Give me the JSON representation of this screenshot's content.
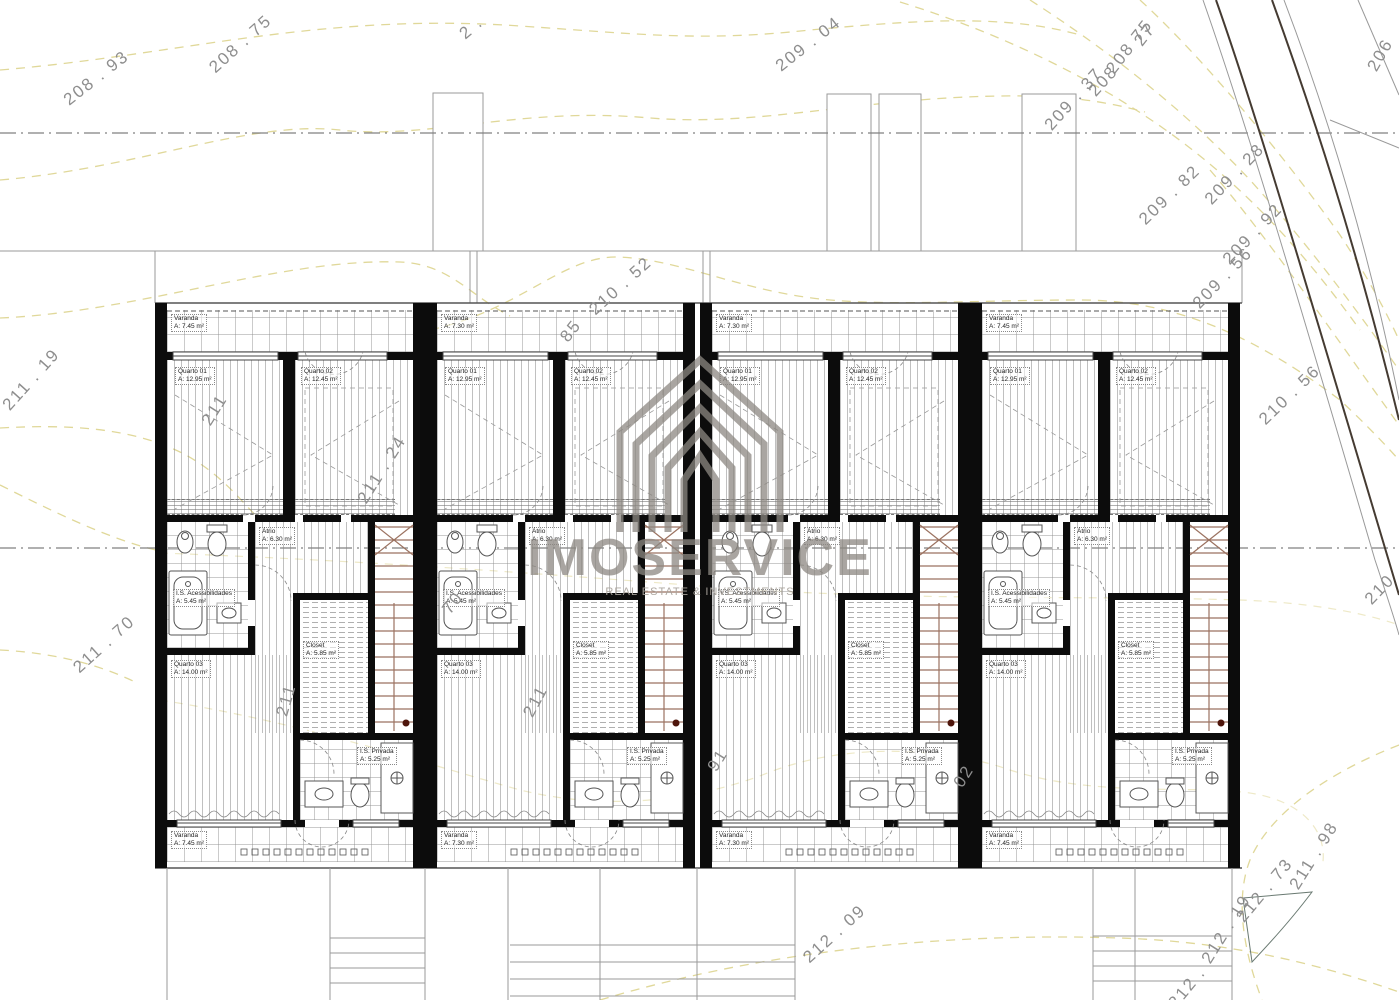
{
  "watermark": {
    "brand": "IMOSERVICE",
    "tagline": "REAL ESTATE & INVESTMENTS",
    "logo": "nested-chevron-house",
    "color": "#8d8882"
  },
  "building": {
    "units": [
      {
        "id": "Unit 1",
        "rooms": [
          {
            "key": "varanda-top",
            "name": "Varanda",
            "area": "A: 7.45 m²"
          },
          {
            "key": "quarto-01",
            "name": "Quarto 01",
            "area": "A: 12.95 m²"
          },
          {
            "key": "quarto-02",
            "name": "Quarto 02",
            "area": "A: 12.45 m²"
          },
          {
            "key": "atrio",
            "name": "Átrio",
            "area": "A: 6.30 m²"
          },
          {
            "key": "is-acessibilidades",
            "name": "I.S. Acessibilidades",
            "area": "A: 5.45 m²"
          },
          {
            "key": "quarto-03",
            "name": "Quarto 03",
            "area": "A: 14.00 m²"
          },
          {
            "key": "closet",
            "name": "Closet",
            "area": "A: 5.85 m²"
          },
          {
            "key": "is-privada",
            "name": "I.S. Privada",
            "area": "A: 5.25 m²"
          },
          {
            "key": "varanda-bottom",
            "name": "Varanda",
            "area": "A: 7.45 m²"
          }
        ]
      },
      {
        "id": "Unit 2",
        "rooms": [
          {
            "key": "varanda-top",
            "name": "Varanda",
            "area": "A: 7.30 m²"
          },
          {
            "key": "quarto-01",
            "name": "Quarto 01",
            "area": "A: 12.95 m²"
          },
          {
            "key": "quarto-02",
            "name": "Quarto 02",
            "area": "A: 12.45 m²"
          },
          {
            "key": "atrio",
            "name": "Átrio",
            "area": "A: 6.30 m²"
          },
          {
            "key": "is-acessibilidades",
            "name": "I.S. Acessibilidades",
            "area": "A: 5.45 m²"
          },
          {
            "key": "quarto-03",
            "name": "Quarto 03",
            "area": "A: 14.00 m²"
          },
          {
            "key": "closet",
            "name": "Closet",
            "area": "A: 5.85 m²"
          },
          {
            "key": "is-privada",
            "name": "I.S. Privada",
            "area": "A: 5.25 m²"
          },
          {
            "key": "varanda-bottom",
            "name": "Varanda",
            "area": "A: 7.30 m²"
          }
        ]
      },
      {
        "id": "Unit 3",
        "rooms": [
          {
            "key": "varanda-top",
            "name": "Varanda",
            "area": "A: 7.30 m²"
          },
          {
            "key": "quarto-01",
            "name": "Quarto 01",
            "area": "A: 12.95 m²"
          },
          {
            "key": "quarto-02",
            "name": "Quarto 02",
            "area": "A: 12.45 m²"
          },
          {
            "key": "atrio",
            "name": "Átrio",
            "area": "A: 6.30 m²"
          },
          {
            "key": "is-acessibilidades",
            "name": "I.S. Acessibilidades",
            "area": "A: 5.45 m²"
          },
          {
            "key": "quarto-03",
            "name": "Quarto 03",
            "area": "A: 14.00 m²"
          },
          {
            "key": "closet",
            "name": "Closet",
            "area": "A: 5.85 m²"
          },
          {
            "key": "is-privada",
            "name": "I.S. Privada",
            "area": "A: 5.25 m²"
          },
          {
            "key": "varanda-bottom",
            "name": "Varanda",
            "area": "A: 7.30 m²"
          }
        ]
      },
      {
        "id": "Unit 4",
        "rooms": [
          {
            "key": "varanda-top",
            "name": "Varanda",
            "area": "A: 7.45 m²"
          },
          {
            "key": "quarto-01",
            "name": "Quarto 01",
            "area": "A: 12.95 m²"
          },
          {
            "key": "quarto-02",
            "name": "Quarto 02",
            "area": "A: 12.45 m²"
          },
          {
            "key": "atrio",
            "name": "Átrio",
            "area": "A: 6.30 m²"
          },
          {
            "key": "is-acessibilidades",
            "name": "I.S. Acessibilidades",
            "area": "A: 5.45 m²"
          },
          {
            "key": "quarto-03",
            "name": "Quarto 03",
            "area": "A: 14.00 m²"
          },
          {
            "key": "closet",
            "name": "Closet",
            "area": "A: 5.85 m²"
          },
          {
            "key": "is-privada",
            "name": "I.S. Privada",
            "area": "A: 5.25 m²"
          },
          {
            "key": "varanda-bottom",
            "name": "Varanda",
            "area": "A: 7.45 m²"
          }
        ]
      }
    ]
  },
  "contour_labels": [
    {
      "text": "208 . 93",
      "x": 66,
      "y": 92,
      "rot": -38
    },
    {
      "text": "208 . 75",
      "x": 212,
      "y": 60,
      "rot": -42
    },
    {
      "text": "2 .",
      "x": 462,
      "y": 26,
      "rot": -40
    },
    {
      "text": "209 . 04",
      "x": 778,
      "y": 58,
      "rot": -38
    },
    {
      "text": "209 . 37",
      "x": 1048,
      "y": 118,
      "rot": -48
    },
    {
      "text": "208",
      "x": 1092,
      "y": 84,
      "rot": -48
    },
    {
      "text": "208 75",
      "x": 1110,
      "y": 62,
      "rot": -52
    },
    {
      "text": "27",
      "x": 1138,
      "y": 34,
      "rot": -52
    },
    {
      "text": "206",
      "x": 1372,
      "y": 60,
      "rot": -60
    },
    {
      "text": "209 . 82",
      "x": 1142,
      "y": 212,
      "rot": -44
    },
    {
      "text": "209 . 28",
      "x": 1208,
      "y": 192,
      "rot": -46
    },
    {
      "text": "209 . 92",
      "x": 1226,
      "y": 252,
      "rot": -46
    },
    {
      "text": "209 . 56",
      "x": 1196,
      "y": 296,
      "rot": -46
    },
    {
      "text": "210 . 52",
      "x": 592,
      "y": 302,
      "rot": -42
    },
    {
      "text": "85",
      "x": 564,
      "y": 330,
      "rot": -52
    },
    {
      "text": "210 . 56",
      "x": 1262,
      "y": 412,
      "rot": -44
    },
    {
      "text": "210",
      "x": 1368,
      "y": 592,
      "rot": -46
    },
    {
      "text": "211 . 19",
      "x": 6,
      "y": 398,
      "rot": -48
    },
    {
      "text": "211 . 70",
      "x": 76,
      "y": 660,
      "rot": -42
    },
    {
      "text": "211",
      "x": 206,
      "y": 414,
      "rot": -58
    },
    {
      "text": "211 . 24",
      "x": 362,
      "y": 492,
      "rot": -58
    },
    {
      "text": "70",
      "x": 446,
      "y": 602,
      "rot": -52
    },
    {
      "text": "211",
      "x": 282,
      "y": 706,
      "rot": -74
    },
    {
      "text": "211",
      "x": 528,
      "y": 706,
      "rot": -62
    },
    {
      "text": "91",
      "x": 712,
      "y": 760,
      "rot": -58
    },
    {
      "text": "02",
      "x": 958,
      "y": 776,
      "rot": -58
    },
    {
      "text": "212 . 09",
      "x": 806,
      "y": 950,
      "rot": -42
    },
    {
      "text": "212 . 19",
      "x": 1206,
      "y": 952,
      "rot": -58
    },
    {
      "text": "212 . 73",
      "x": 1240,
      "y": 910,
      "rot": -50
    },
    {
      "text": "211 . 98",
      "x": 1294,
      "y": 878,
      "rot": -58
    },
    {
      "text": "212 .",
      "x": 1172,
      "y": 996,
      "rot": -50
    }
  ],
  "colors": {
    "wall": "#0c0c0c",
    "contour_line": "#ddd48f",
    "contour_label": "#8e8e8e",
    "stair_tread": "#9b7260",
    "stair_dot": "#4e150b",
    "road": "#453b32",
    "thin_line": "#9a9a9a"
  }
}
